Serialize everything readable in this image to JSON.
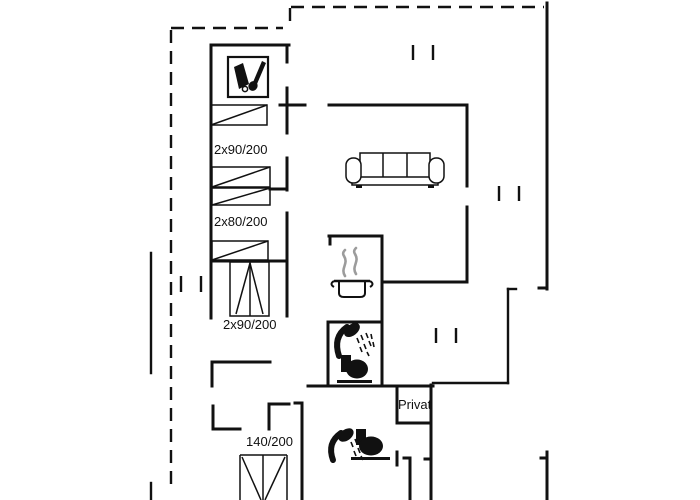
{
  "document": {
    "type": "floor-plan",
    "background": "#ffffff",
    "line_color": "#111111",
    "steam_color": "#9c9c9c"
  },
  "labels": {
    "bed1": "2x90/200",
    "bed2": "2x80/200",
    "bed3": "2x90/200",
    "bed4": "140/200",
    "privat": "Privat"
  },
  "icons": [
    {
      "name": "cleaning-tools-icon"
    },
    {
      "name": "single-bed-icon"
    },
    {
      "name": "single-bed-icon"
    },
    {
      "name": "single-bed-icon"
    },
    {
      "name": "single-bed-icon"
    },
    {
      "name": "double-bed-icon"
    },
    {
      "name": "double-bed-icon"
    },
    {
      "name": "sofa-icon"
    },
    {
      "name": "cooking-pot-icon"
    },
    {
      "name": "steam-icon"
    },
    {
      "name": "shower-icon"
    },
    {
      "name": "toilet-icon"
    },
    {
      "name": "shower-icon"
    },
    {
      "name": "toilet-icon"
    },
    {
      "name": "window-marker"
    },
    {
      "name": "window-marker"
    },
    {
      "name": "window-marker"
    },
    {
      "name": "window-marker"
    }
  ]
}
